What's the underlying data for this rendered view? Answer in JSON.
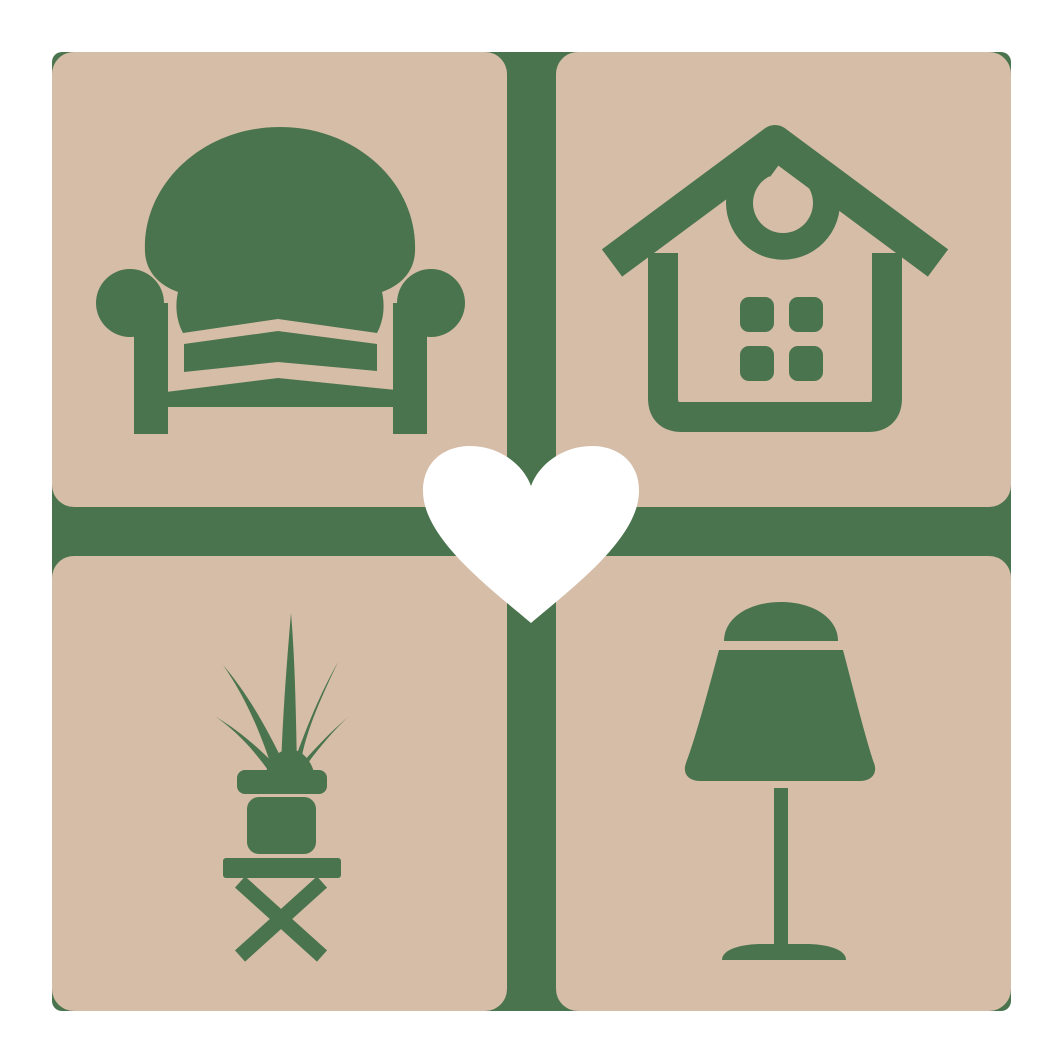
{
  "colors": {
    "background": "#ffffff",
    "tile": "#d5bda7",
    "accent": "#4a744e",
    "heart": "#ffffff"
  },
  "logo": {
    "name": "home-furniture-love-logo",
    "tiles": [
      {
        "position": "top-left",
        "icon": "armchair-icon"
      },
      {
        "position": "top-right",
        "icon": "house-icon"
      },
      {
        "position": "bottom-left",
        "icon": "potted-plant-icon"
      },
      {
        "position": "bottom-right",
        "icon": "table-lamp-icon"
      }
    ],
    "center": {
      "icon": "heart-icon"
    }
  }
}
